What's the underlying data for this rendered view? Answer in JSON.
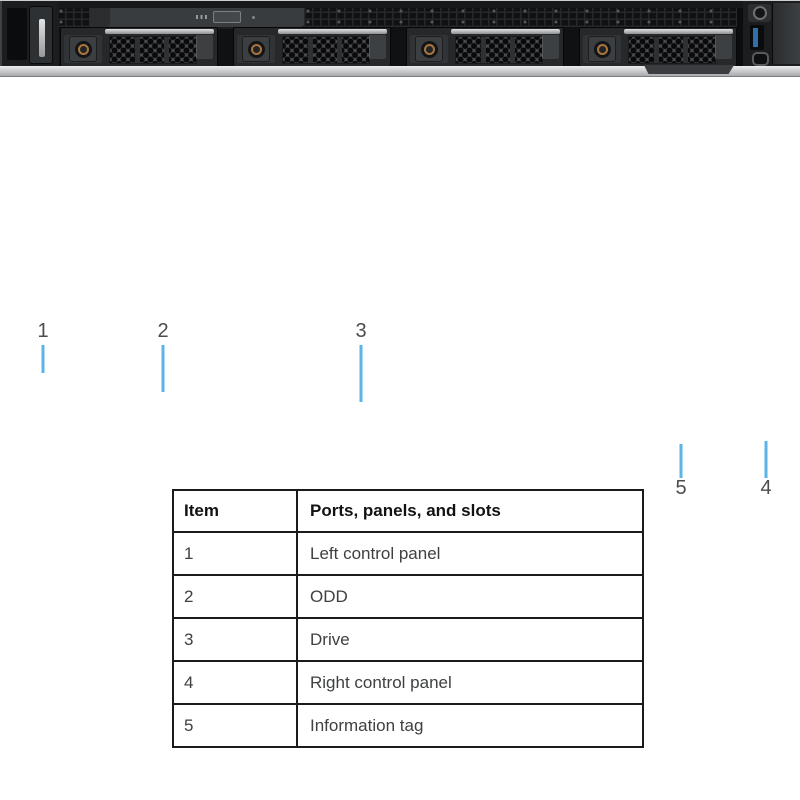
{
  "figure": {
    "callouts": [
      {
        "num": "1",
        "target": "Left control panel"
      },
      {
        "num": "2",
        "target": "ODD"
      },
      {
        "num": "3",
        "target": "Drive"
      },
      {
        "num": "4",
        "target": "Right control panel"
      },
      {
        "num": "5",
        "target": "Information tag"
      }
    ]
  },
  "table": {
    "headers": {
      "item": "Item",
      "description": "Ports, panels, and slots"
    },
    "rows": [
      {
        "item": "1",
        "description": "Left control panel"
      },
      {
        "item": "2",
        "description": "ODD"
      },
      {
        "item": "3",
        "description": "Drive"
      },
      {
        "item": "4",
        "description": "Right control panel"
      },
      {
        "item": "5",
        "description": "Information tag"
      }
    ]
  },
  "colors": {
    "leader_line": "#5bb4e5",
    "callout_text": "#4a4c4e",
    "usb_port_blue": "#2e6fae",
    "drive_lock_ring": "#a9753e",
    "table_border": "#1b1b1b"
  }
}
